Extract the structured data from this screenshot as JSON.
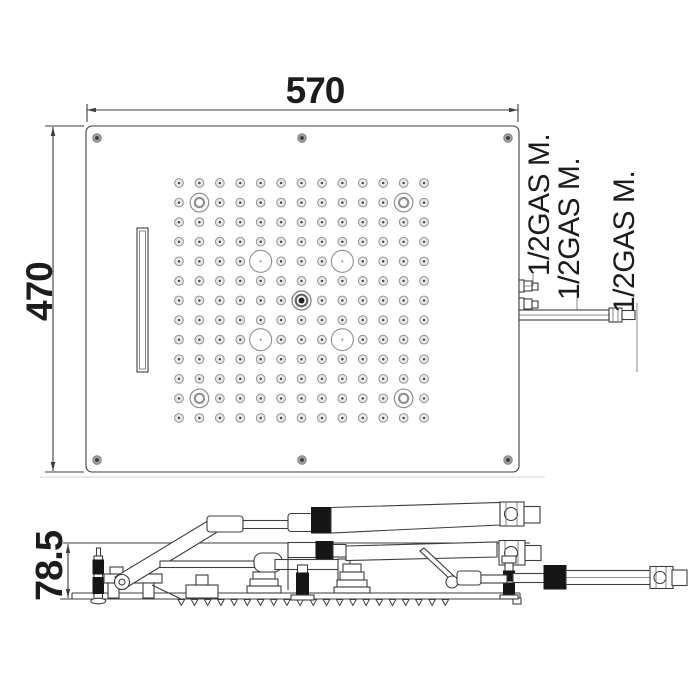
{
  "dimensions": {
    "width": "570",
    "height": "470",
    "depth": "78.5"
  },
  "connection_labels": [
    "1/2GAS M.",
    "1/2GAS M.",
    "1/2GAS M."
  ],
  "colors": {
    "line": "#3d3d3d",
    "nozzle_line": "#8f8f8f",
    "nozzle_fill": "#e0e0e0",
    "coupler_black": "#161616",
    "background": "#ffffff"
  },
  "top_view": {
    "panel": {
      "x": 86,
      "y": 126,
      "w": 433,
      "h": 346,
      "corner_radius": 6
    },
    "screws": [
      [
        97,
        138
      ],
      [
        302,
        138
      ],
      [
        508,
        138
      ],
      [
        97,
        460
      ],
      [
        302,
        460
      ],
      [
        508,
        460
      ]
    ],
    "waterfall_slot": {
      "x": 137,
      "y": 228,
      "w": 11,
      "h": 144
    },
    "nozzle_grid": {
      "cols": 13,
      "rows": 13,
      "x0": 179,
      "y0": 183,
      "dx": 20.42,
      "dy": 19.58,
      "ring_positions": [
        [
          2,
          2
        ],
        [
          12,
          2
        ],
        [
          2,
          12
        ],
        [
          12,
          12
        ]
      ],
      "medium_circle_positions": [
        [
          5,
          5
        ],
        [
          9,
          5
        ],
        [
          5,
          9
        ],
        [
          9,
          9
        ]
      ],
      "center_position": [
        7,
        7
      ]
    }
  },
  "side_view": {
    "serrations": {
      "x_start": 178,
      "x_end": 452,
      "step": 13.2,
      "w": 6.6,
      "h": 6,
      "y": 599.5
    }
  }
}
